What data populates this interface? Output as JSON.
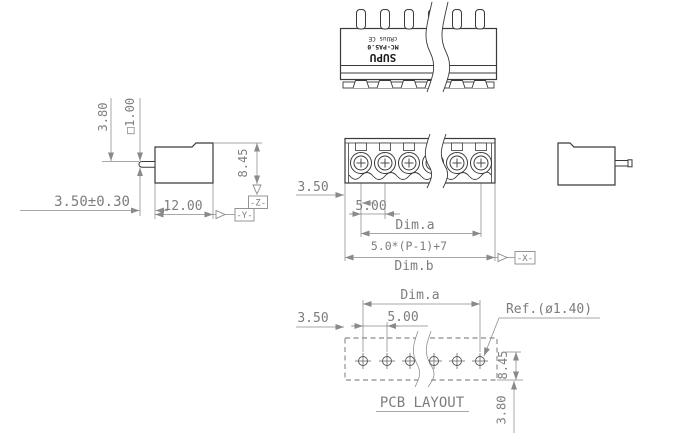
{
  "colors": {
    "background": "#ffffff",
    "part_line": "#3a3a3a",
    "dim_line": "#8a8a8a",
    "dim_text": "#7d7d7d"
  },
  "top_view": {
    "marking": {
      "brand": "SUPU",
      "model": "MC-PA5.0",
      "cert": "cRUus CE"
    }
  },
  "side_view": {
    "pin_length": "3.80",
    "pin_square": "□1.00",
    "tail_length": "3.50±0.30",
    "body_depth": "12.00",
    "body_height": "8.45",
    "datum_y": "-Y-",
    "datum_z": "-Z-"
  },
  "front_view": {
    "edge_to_pin": "3.50",
    "pitch": "5.00",
    "dim_a": "Dim.a",
    "dim_b_formula": "5.0*(P-1)+7",
    "dim_b": "Dim.b",
    "datum_x": "-X-"
  },
  "pcb_layout": {
    "dim_a": "Dim.a",
    "edge_to_hole": "3.50",
    "pitch": "5.00",
    "hole_ref": "Ref.(ø1.40)",
    "row_offset": "8.45",
    "hole_to_edge": "3.80",
    "caption": "PCB LAYOUT"
  }
}
